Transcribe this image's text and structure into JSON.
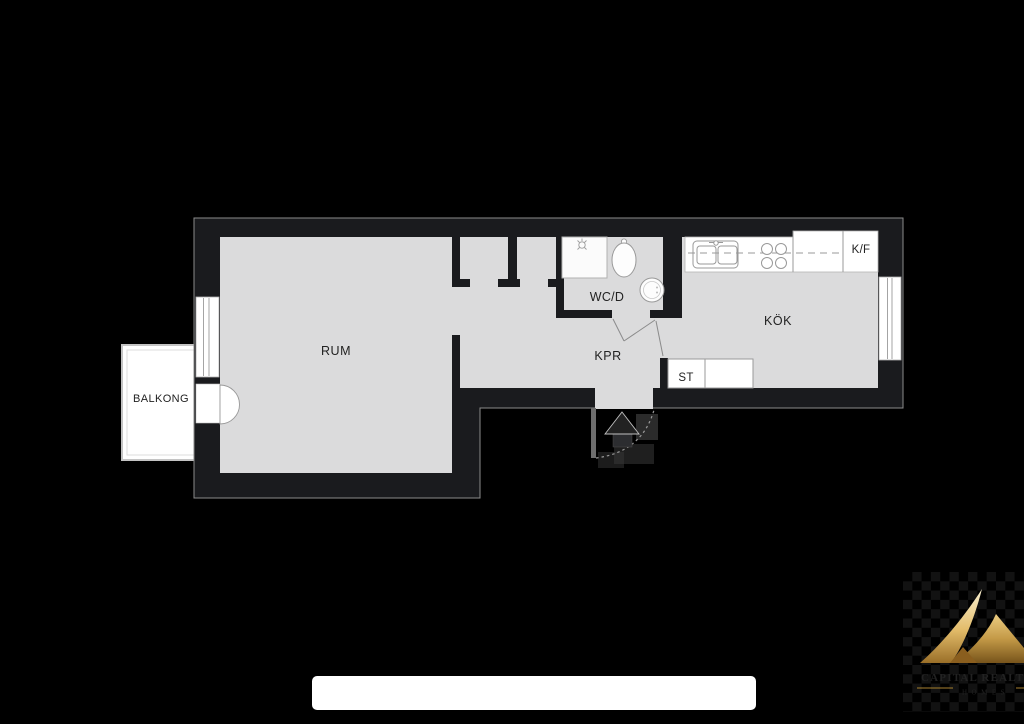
{
  "floorplan": {
    "labels": {
      "room": "RUM",
      "balcony": "BALKONG",
      "bathroom": "WC/D",
      "hallway": "KPR",
      "kitchen": "KÖK",
      "cleaning_closet": "ST",
      "fridge_freezer": "K/F"
    },
    "fixtures": {
      "bathroom": [
        "shower",
        "toilet",
        "washing-machine"
      ],
      "kitchen": [
        "sink",
        "stove",
        "counter",
        "fridge-freezer"
      ],
      "hallway": [
        "wardrobe-niches",
        "entrance-door",
        "north-arrow"
      ]
    },
    "colors": {
      "background": "#000000",
      "wall": "#1a1b1e",
      "wall_outline": "#8b8b8b",
      "floor": "#dbdbdc",
      "fixture_fill": "#ffffff",
      "fixture_stroke": "#9a9a9a",
      "label_text": "#222222",
      "redaction_bar": "#ffffff"
    }
  },
  "watermark": {
    "address_bar_text": ""
  },
  "logo": {
    "name": "CAPITAL REALTY",
    "tagline": "HOMES",
    "gold_light": "#f9f0d0",
    "gold_mid": "#e3bc6a",
    "gold_dark": "#9a6f28",
    "text_gold": "#c09544"
  }
}
